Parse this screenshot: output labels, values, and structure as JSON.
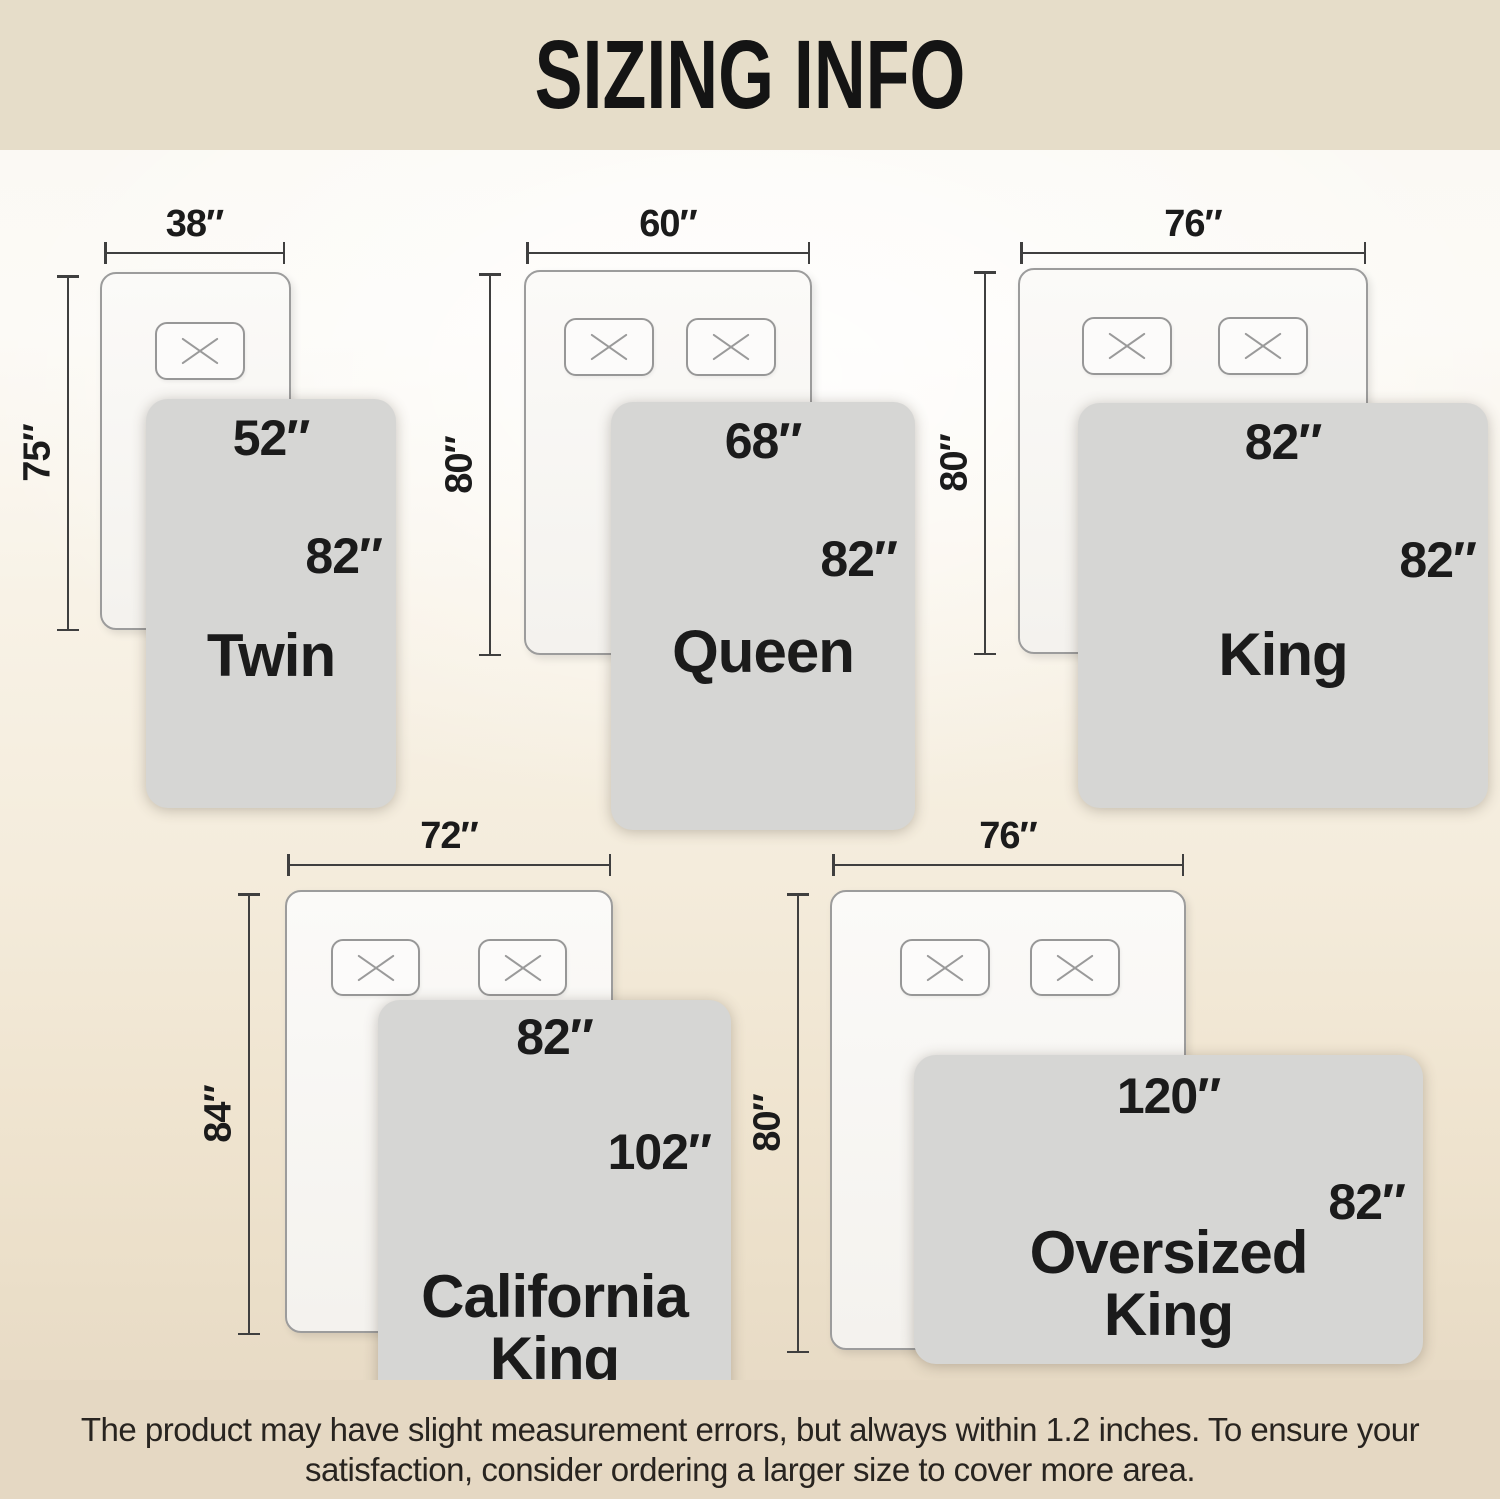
{
  "header": {
    "title": "SIZING INFO"
  },
  "sizes": [
    {
      "id": "twin",
      "name_line1": "Twin",
      "name_line2": "",
      "bed_width": "38″",
      "bed_height": "75″",
      "blanket_width": "52″",
      "blanket_length": "82″",
      "pillows": 1
    },
    {
      "id": "queen",
      "name_line1": "Queen",
      "name_line2": "",
      "bed_width": "60″",
      "bed_height": "80″",
      "blanket_width": "68″",
      "blanket_length": "82″",
      "pillows": 2
    },
    {
      "id": "king",
      "name_line1": "King",
      "name_line2": "",
      "bed_width": "76″",
      "bed_height": "80″",
      "blanket_width": "82″",
      "blanket_length": "82″",
      "pillows": 2
    },
    {
      "id": "california-king",
      "name_line1": "California",
      "name_line2": "King",
      "bed_width": "72″",
      "bed_height": "84″",
      "blanket_width": "82″",
      "blanket_length": "102″",
      "pillows": 2
    },
    {
      "id": "oversized-king",
      "name_line1": "Oversized",
      "name_line2": "King",
      "bed_width": "76″",
      "bed_height": "80″",
      "blanket_width": "120″",
      "blanket_length": "82″",
      "pillows": 2
    }
  ],
  "footer": {
    "line1": "The product may have slight measurement errors, but always within 1.2 inches. To ensure your",
    "line2": "satisfaction, consider ordering a larger size to cover more area."
  },
  "icons": {
    "pillow_marker": "x-cross"
  },
  "colors": {
    "header_bg": "#e6ddc9",
    "footer_bg": "#e5d8c3",
    "blanket": "#d6d6d4",
    "bed": "#f8f7f5",
    "bed_border": "#9c9c9c",
    "line": "#3f3f3f",
    "text": "#1b1b1b"
  }
}
